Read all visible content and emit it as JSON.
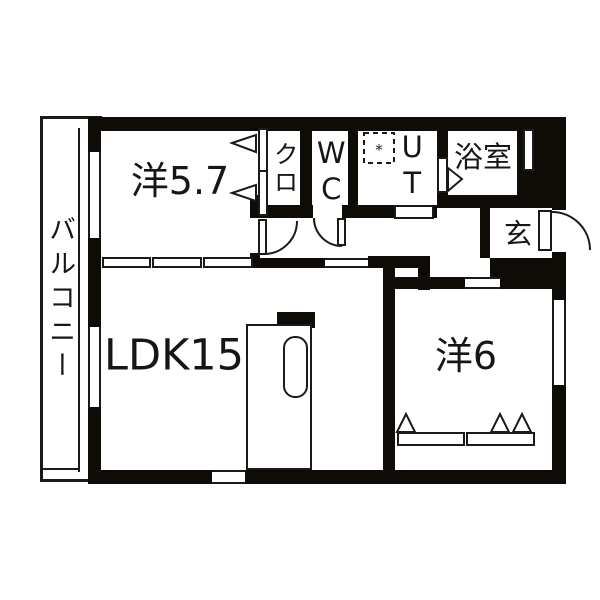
{
  "type": "apartment-floor-plan",
  "colors": {
    "wall": "#0f0b07",
    "line": "#1a1a1a",
    "background": "#ffffff"
  },
  "rooms": {
    "balcony": {
      "label": "バルコニー"
    },
    "western_5_7": {
      "label": "洋5.7"
    },
    "closet": {
      "label": "クロ"
    },
    "toilet": {
      "label": "WC"
    },
    "utility": {
      "label": "UT"
    },
    "bathroom": {
      "label": "浴室"
    },
    "entrance": {
      "label": "玄"
    },
    "ldk": {
      "label": "LDK15"
    },
    "western_6": {
      "label": "洋6"
    }
  },
  "symbols": {
    "washing_machine_mark": "*"
  }
}
